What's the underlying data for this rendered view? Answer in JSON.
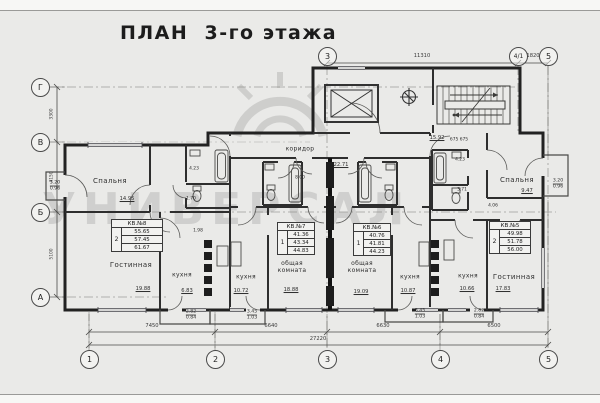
{
  "title": "ПЛАН  3-го этажа",
  "watermark": "УНИВЕРСАЛ",
  "axes": {
    "rows": [
      "Г",
      "В",
      "Б",
      "А"
    ],
    "cols_bottom": [
      "1",
      "2",
      "3",
      "4",
      "5"
    ],
    "cols_top": [
      "3",
      "4/1",
      "5"
    ]
  },
  "dims": {
    "top_3_41": "11310",
    "top_41_5": "1820",
    "bot_1_2": "7450",
    "bot_2_3": "6640",
    "bot_3_4": "6630",
    "bot_4_5": "6500",
    "total": "27220",
    "left_g_v": "3300",
    "left_v_b": "4150",
    "left_b_a": "5100",
    "stair_steps": "675 675"
  },
  "apartments": [
    {
      "id": "КВ.№8",
      "rooms": "2",
      "areas": [
        "55.65",
        "57.45",
        "61.67"
      ]
    },
    {
      "id": "КВ.№7",
      "rooms": "1",
      "areas": [
        "41.36",
        "43.34",
        "44.83"
      ]
    },
    {
      "id": "КВ.№6",
      "rooms": "1",
      "areas": [
        "40.76",
        "41.81",
        "44.23"
      ]
    },
    {
      "id": "КВ.№5",
      "rooms": "2",
      "areas": [
        "49.98",
        "51.78",
        "56.00"
      ]
    }
  ],
  "rooms": {
    "bedroom8": {
      "label": "Спальня",
      "area": "14.95"
    },
    "living8": {
      "label": "Гостинная",
      "area": "19.88"
    },
    "kitchen8": {
      "label": "кухня",
      "area": "6.83"
    },
    "kitchen7": {
      "label": "кухня",
      "area": "10.72"
    },
    "common7": {
      "label": "общая комната",
      "area": "18.88"
    },
    "common6": {
      "label": "общая комната",
      "area": "19.09"
    },
    "kitchen6": {
      "label": "кухня",
      "area": "10.87"
    },
    "kitchen5": {
      "label": "кухня",
      "area": "10.66"
    },
    "living5": {
      "label": "Гостинная",
      "area": "17.83"
    },
    "bedroom5": {
      "label": "Спальня",
      "area": "9.47"
    },
    "corridor": {
      "label": "коридор",
      "area": "22.71"
    },
    "stair_hall": {
      "area": "15.92"
    }
  },
  "small_dims": {
    "bath8_a": "4.23",
    "bath8_b": "1.70",
    "bath8_c": "1.98",
    "hall7": "8.00",
    "bath5_a": "4.23",
    "bath5_b": "3.71",
    "hall5": "4.06"
  },
  "balconies": {
    "left": {
      "a": "3.20",
      "b": "0.96"
    },
    "right": {
      "a": "3.20",
      "b": "0.96"
    },
    "b1": {
      "a": "2.82",
      "b": "0.84"
    },
    "b2": {
      "a": "3.45",
      "b": "1.03"
    },
    "b3": {
      "a": "3.45",
      "b": "1.03"
    },
    "b4": {
      "a": "2.82",
      "b": "0.84"
    }
  }
}
